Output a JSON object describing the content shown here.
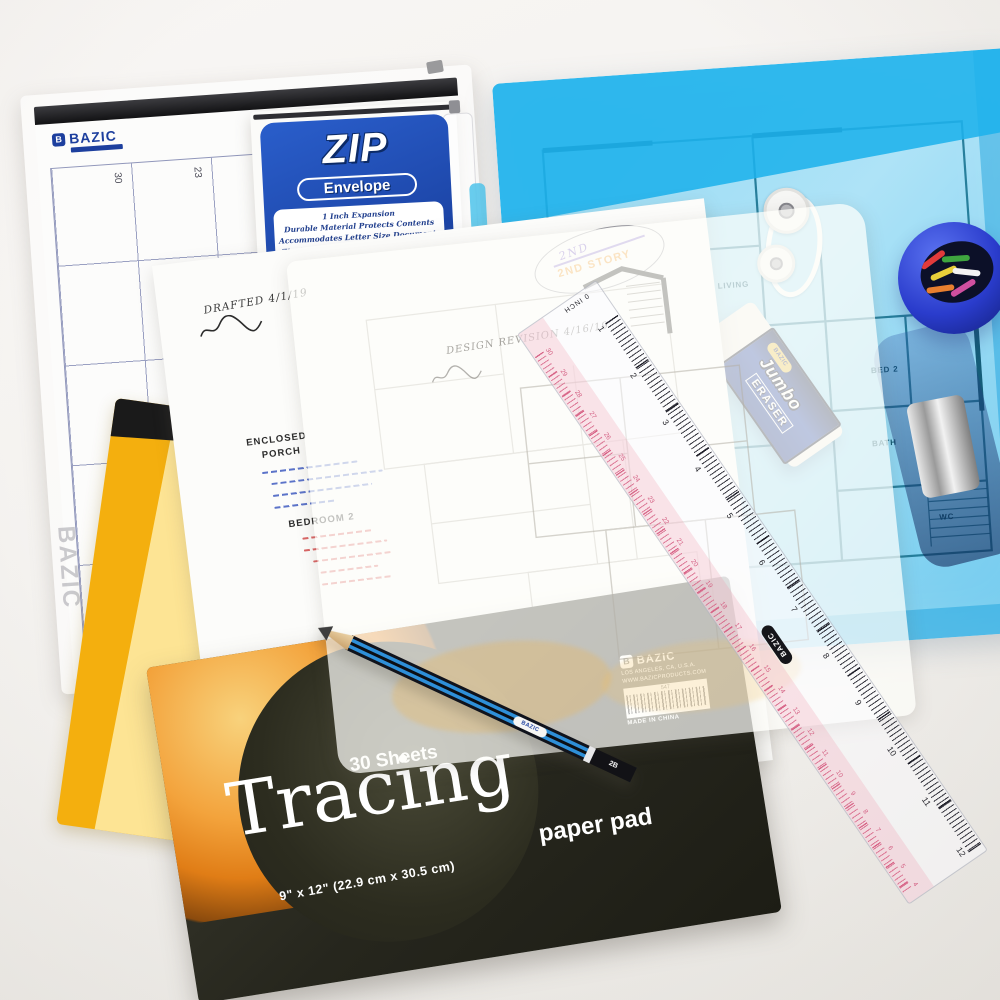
{
  "scene": {
    "description": "Flat-lay photograph of BAZIC drafting supplies with architectural floor plans",
    "background": "#f3f1ee"
  },
  "calendar": {
    "brand": "BAZIC",
    "day_numbers": [
      "30",
      "23",
      "16",
      "9",
      "24",
      "17",
      "10",
      "25",
      "26",
      "29"
    ],
    "watermark": "BAZIC"
  },
  "zip_package": {
    "title": "ZIP",
    "subtitle": "Envelope",
    "features": [
      "1 Inch Expansion",
      "Durable Material Protects Contents",
      "Accommodates Letter Size Documents",
      "Zip Closure for Convenient Resealing"
    ],
    "brand": "BAZIC",
    "label_color": "#1e4fb0"
  },
  "blue_envelope": {
    "rooms": [
      "DINING",
      "LIVING",
      "BED 2",
      "STUDY",
      "BATH",
      "WC"
    ],
    "body_color": "#8ed7f2",
    "flap_color": "#1eb2ec",
    "plan_line_color": "#14708f"
  },
  "clip_cup": {
    "clip_colors": [
      "#e23b3b",
      "#3fa53f",
      "#e8cf3a",
      "#f3f3f3",
      "#e87f2f",
      "#cf4f9f"
    ]
  },
  "eraser": {
    "brand": "BAZIC",
    "line1": "Jumbo",
    "line2": "ERASER",
    "sleeve_color": "#16307e"
  },
  "ruler": {
    "brand": "BAZIC",
    "zero_label": "0",
    "inch_label": "INCH",
    "inch_numbers": [
      "1",
      "2",
      "3",
      "4",
      "5",
      "6",
      "7",
      "8",
      "9",
      "10",
      "11",
      "12"
    ],
    "cm_numbers": [
      "30",
      "29",
      "28",
      "27",
      "26",
      "25",
      "24",
      "23",
      "22",
      "21",
      "20",
      "19",
      "18",
      "17",
      "16",
      "15",
      "14",
      "13",
      "12",
      "11",
      "10",
      "9",
      "8",
      "7",
      "6",
      "5",
      "4"
    ],
    "cm_color": "#d86084"
  },
  "sketch": {
    "drafted_note": "DRAFTED 4/1/19",
    "heading1": "ENCLOSED",
    "heading2": "PORCH",
    "heading3": "BEDROOM 2",
    "stamp_hand": "2ND",
    "stamp_text": "2ND STORY",
    "note_blue": "#3f5bc0",
    "note_red": "#d34b4b"
  },
  "tracing_overlay": {
    "revision_note": "DESIGN REVISION 4/16/19"
  },
  "tracing_pad": {
    "sheets": "30 Sheets",
    "title": "Tracing",
    "subtitle": "paper pad",
    "size": "9\" x 12\" (22.9 cm x 30.5 cm)",
    "brand": "BAZIC",
    "address": "LOS ANGELES, CA, U.S.A.",
    "website": "WWW.BAZICPRODUCTS.COM",
    "sku": "547",
    "origin": "MADE IN CHINA"
  },
  "pencil": {
    "brand": "BAZIC",
    "grade": "2B"
  }
}
